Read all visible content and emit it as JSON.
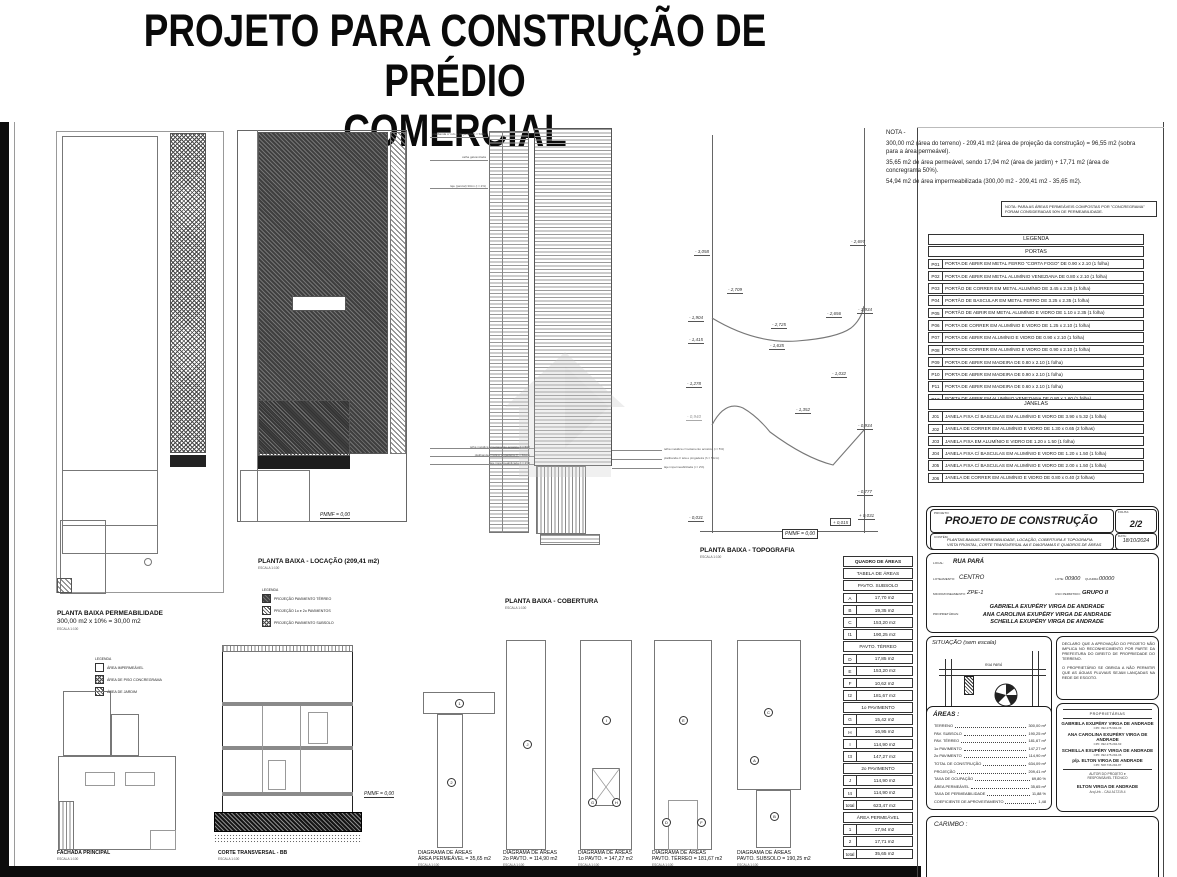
{
  "title": {
    "line1": "PROJETO PARA CONSTRUÇÃO DE PRÉDIO",
    "line2": "COMERCIAL"
  },
  "nota": {
    "heading": "NOTA -",
    "line1": "300,00 m2 (área do terreno) - 209,41 m2 (área de projeção da construção) = 96,55 m2 (sobra para a área permeável).",
    "line2": "35,65 m2 de área permeável, sendo 17,94 m2 (área de jardim) + 17,71 m2 (área de concregrama 50%).",
    "line3": "54,94 m2 de área impermeabilizada (300,00 m2 - 209,41 m2 - 35,65 m2).",
    "boxed": "NOTA: PARA AS ÁREAS PERMEÁVEIS COMPOSTAS POR \"CONCREGRAMA\" FORAM CONSIDERADAS 50% DE PERMEABILIDADE."
  },
  "legenda": {
    "title": "LEGENDA",
    "portas_title": "PORTAS",
    "portas": [
      {
        "code": "P01",
        "desc": "PORTA DE ABRIR EM METAL FERRO \"CORTA FOGO\" DE 0.90 x 2.10 (1 folha)"
      },
      {
        "code": "P02",
        "desc": "PORTA DE ABRIR EM METAL ALUMÍNIO VENEZIANA DE 0.80 x 2.10 (1 folha)"
      },
      {
        "code": "P03",
        "desc": "PORTÃO DE CORRER EM METAL ALUMÍNIO DE 3.45 x 2.35 (1 folha)"
      },
      {
        "code": "P04",
        "desc": "PORTÃO DE BASCULAR EM METAL FERRO DE 3.25 x 2.35 (1 folha)"
      },
      {
        "code": "P05",
        "desc": "PORTÃO DE ABRIR EM METAL ALUMÍNIO E VIDRO DE 1.10 x 2.35 (1 folha)"
      },
      {
        "code": "P06",
        "desc": "PORTA DE CORRER EM ALUMÍNIO E VIDRO DE 1.25 x 2.10 (1 folha)"
      },
      {
        "code": "P07",
        "desc": "PORTA DE ABRIR EM ALUMÍNIO E VIDRO DE 0.90 x 2.10 (1 folha)"
      },
      {
        "code": "P08",
        "desc": "PORTA DE CORRER EM ALUMÍNIO E VIDRO DE 0.90 x 2.10 (1 folha)"
      },
      {
        "code": "P09",
        "desc": "PORTA DE ABRIR EM MADEIRA DE 0.80 x 2.10 (1 folha)"
      },
      {
        "code": "P10",
        "desc": "PORTA DE ABRIR EM MADEIRA DE 0.90 x 2.10 (1 folha)"
      },
      {
        "code": "P11",
        "desc": "PORTA DE ABRIR EM MADEIRA DE 0.60 x 2.10 (1 folha)"
      },
      {
        "code": "P12",
        "desc": "PORTA DE ABRIR EM ALUMÍNIO VENEZIANA DE 0.80 x 1.60 (1 folha)"
      }
    ],
    "janelas_title": "JANELAS",
    "janelas": [
      {
        "code": "J01",
        "desc": "JANELA FIXA C/ BASCULAS EM ALUMÍNIO E VIDRO DE 3.90 x 5.32 (1 folha)"
      },
      {
        "code": "J02",
        "desc": "JANELA DE CORRER EM ALUMÍNIO E VIDRO DE 1.30 x 0.65 (2 folhas)"
      },
      {
        "code": "J03",
        "desc": "JANELA FIXA EM ALUMÍNIO E VIDRO DE 1.20 x 1.50 (1 folha)"
      },
      {
        "code": "J04",
        "desc": "JANELA FIXA C/ BASCULAS EM ALUMÍNIO E VIDRO DE 1.20 x 1.50 (1 folha)"
      },
      {
        "code": "J05",
        "desc": "JANELA FIXA C/ BASCULAS EM ALUMÍNIO E VIDRO DE 2.00 x 1.50 (1 folha)"
      },
      {
        "code": "J06",
        "desc": "JANELA DE CORRER EM ALUMÍNIO E VIDRO DE 0.80 x 0.40 (2 folhas)"
      }
    ]
  },
  "quadro": {
    "title": "QUADRO DE ÁREAS",
    "rows": [
      {
        "h": "TABELA DE ÁREAS"
      },
      {
        "h": "PAVTO. SUBSOLO"
      },
      {
        "l": "A",
        "v": "17,70 m2"
      },
      {
        "l": "B",
        "v": "19,35 m2"
      },
      {
        "l": "C",
        "v": "153,20 m2"
      },
      {
        "l": "t1",
        "v": "190,25 m2"
      },
      {
        "h": "PAVTO. TÉRREO"
      },
      {
        "l": "D",
        "v": "17,85 m2"
      },
      {
        "l": "E",
        "v": "153,20 m2"
      },
      {
        "l": "F",
        "v": "10,62 m2"
      },
      {
        "l": "t2",
        "v": "181,67 m2"
      },
      {
        "h": "1o PAVIMENTO"
      },
      {
        "l": "G",
        "v": "15,42 m2"
      },
      {
        "l": "H",
        "v": "16,95 m2"
      },
      {
        "l": "I",
        "v": "114,90 m2"
      },
      {
        "l": "t3",
        "v": "147,27 m2"
      },
      {
        "h": "2o PAVIMENTO"
      },
      {
        "l": "J",
        "v": "114,90 m2"
      },
      {
        "l": "t4",
        "v": "114,90 m2"
      },
      {
        "l": "total",
        "v": "623,47 m2"
      },
      {
        "h": "ÁREA PERMEÁVEL"
      },
      {
        "l": "1",
        "v": "17,94 m2"
      },
      {
        "l": "2",
        "v": "17,71 m2"
      },
      {
        "l": "total",
        "v": "35,65 m2"
      }
    ]
  },
  "plans": {
    "permeabilidade_l1": "PLANTA BAIXA PERMEABILIDADE",
    "permeabilidade_l2": "300,00 m2 x 10% = 30,00 m2",
    "locacao": "PLANTA BAIXA - LOCAÇÃO (209,41 m2)",
    "cobertura": "PLANTA BAIXA - COBERTURA",
    "topografia": "PLANTA BAIXA - TOPOGRAFIA",
    "fachada": "FACHADA PRINCIPAL",
    "corte": "CORTE TRANSVERSAL - BB",
    "escala": "ESCALA 1:100",
    "pmmf": "PMMF = 0,00"
  },
  "legend_permeavel": {
    "title": "LEGENDA",
    "items": [
      "ÁREA IMPERMEÁVEL",
      "ÁREA DE PISO CONCREGRAMA",
      "ÁREA DE JARDIM"
    ]
  },
  "legend_locacao": {
    "title": "LEGENDA",
    "items": [
      "PROJEÇÃO PAVIMENTO TÉRREO",
      "PROJEÇÃO 1o e 2o PAVIMENTOS",
      "PROJEÇÃO PAVIMENTO SUBSOLO"
    ]
  },
  "topografia": {
    "elevations": [
      {
        "t": "- 3,058",
        "x": 694,
        "y": 249
      },
      {
        "t": "- 2,697",
        "x": 850,
        "y": 239
      },
      {
        "t": "- 2,709",
        "x": 727,
        "y": 287
      },
      {
        "t": "- 1,904",
        "x": 688,
        "y": 315
      },
      {
        "t": "- 2,725",
        "x": 771,
        "y": 322
      },
      {
        "t": "- 2,656",
        "x": 826,
        "y": 311
      },
      {
        "t": "- 1,934",
        "x": 857,
        "y": 307
      },
      {
        "t": "- 1,415",
        "x": 688,
        "y": 337
      },
      {
        "t": "- 1,635",
        "x": 769,
        "y": 343
      },
      {
        "t": "- 1,278",
        "x": 686,
        "y": 381
      },
      {
        "t": "- 1,032",
        "x": 831,
        "y": 371
      },
      {
        "t": "- 0,940",
        "x": 686,
        "y": 414,
        "gray": true
      },
      {
        "t": "- 1,352",
        "x": 795,
        "y": 407
      },
      {
        "t": "- 0,934",
        "x": 857,
        "y": 423
      },
      {
        "t": "- 0,777",
        "x": 857,
        "y": 489
      },
      {
        "t": "- 0,031",
        "x": 688,
        "y": 515
      },
      {
        "t": "+ 0,015",
        "x": 830,
        "y": 518,
        "boxed": true
      },
      {
        "t": "+ 0,031",
        "x": 858,
        "y": 513
      }
    ]
  },
  "anno_cobertura": [
    {
      "t": "platibanda c/ rufo e pingadeira h = 50cm",
      "x": 486,
      "y": 132,
      "side": "l"
    },
    {
      "t": "calha galvanizada",
      "x": 486,
      "y": 155,
      "side": "l"
    },
    {
      "t": "laje (parcial) 30cm (i = 2%)",
      "x": 486,
      "y": 184,
      "side": "l"
    },
    {
      "t": "telha metálica c/ isolamento acústico (i = 5%)",
      "x": 530,
      "y": 445,
      "side": "l"
    },
    {
      "t": "platibanda c/ tela e pingadeira (h = 50cm)",
      "x": 530,
      "y": 453,
      "side": "l"
    },
    {
      "t": "laje impermeabilizada (i = 2%)",
      "x": 530,
      "y": 461,
      "side": "l"
    },
    {
      "t": "telha metálica c/ isolamento acústico (i = 5%)",
      "x": 664,
      "y": 447,
      "side": "r"
    },
    {
      "t": "platibanda c/ tela e pingadeira (h = 50cm)",
      "x": 664,
      "y": 456,
      "side": "r"
    },
    {
      "t": "laje impermeabilizada (i = 2%)",
      "x": 664,
      "y": 465,
      "side": "r"
    }
  ],
  "diagramas": {
    "heading": "DIAGRAMA DE ÁREAS",
    "items": [
      {
        "x": 418,
        "sub": "ÁREA PERMEÁVEL = 35,65 m2"
      },
      {
        "x": 503,
        "sub": "2o PAVTO. = 114,90 m2"
      },
      {
        "x": 578,
        "sub": "1o PAVTO. = 147,27 m2"
      },
      {
        "x": 652,
        "sub": "PAVTO. TÉRREO = 181,67 m2"
      },
      {
        "x": 737,
        "sub": "PAVTO. SUBSOLO = 190,25 m2"
      }
    ],
    "markers": [
      {
        "t": "1",
        "x": 455,
        "y": 699
      },
      {
        "t": "2",
        "x": 447,
        "y": 778
      },
      {
        "t": "J",
        "x": 523,
        "y": 740
      },
      {
        "t": "I",
        "x": 602,
        "y": 716
      },
      {
        "t": "G",
        "x": 588,
        "y": 798
      },
      {
        "t": "H",
        "x": 612,
        "y": 798
      },
      {
        "t": "E",
        "x": 679,
        "y": 716
      },
      {
        "t": "D",
        "x": 662,
        "y": 818
      },
      {
        "t": "F",
        "x": 697,
        "y": 818
      },
      {
        "t": "C",
        "x": 764,
        "y": 708
      },
      {
        "t": "A",
        "x": 750,
        "y": 756
      },
      {
        "t": "B",
        "x": 770,
        "y": 812
      }
    ]
  },
  "titleblock": {
    "projeto_label": "PROJETO:",
    "projeto": "PROJETO DE CONSTRUÇÃO",
    "folha_label": "FOLHA:",
    "folha": "2/2",
    "contem_label": "CONTÉM:",
    "contem1": "PLANTAS BAIXAS PERMEABILIDADE, LOCAÇÃO, COBERTURA E TOPOGRAFIA",
    "contem2": "VISTA FRONTAL, CORTE TRANSVERSAL AA E DIAGRAMAS E QUADROS DE ÁREAS",
    "data_label": "DATA:",
    "data": "18/10/2024",
    "local_label": "LOCAL:",
    "local": "RUA PARÁ",
    "loteamento_label": "LOTEAMENTO:",
    "loteamento": "CENTRO",
    "lote_label": "LOTE:",
    "lote": "00900",
    "quadra_label": "QUADRA:",
    "quadra": "00000",
    "micro_label": "MICROZONEAMENTO:",
    "micro": "ZPE-1",
    "uso_label": "USO PERMITIDO:",
    "uso": "GRUPO II",
    "prop_label": "PROPRIETÁRIAS:",
    "prop1": "GABRIELA EXUPÉRY VIRGA DE ANDRADE",
    "prop2": "ANA CAROLINA EXUPÉRY VIRGA DE ANDRADE",
    "prop3": "SCHEILLA EXUPÉRY VIRGA DE ANDRADE"
  },
  "situacao": {
    "title": "SITUAÇÃO (sem escala)",
    "rua": "RUA PARÁ",
    "north": "N"
  },
  "declaracao": {
    "p1": "DECLARO QUE A APROVAÇÃO DO PROJETO NÃO IMPLICA NO RECONHECIMENTO POR PARTE DA PREFEITURA DO DIREITO DE PROPRIEDADE DO TERRENO.",
    "p2": "O PROPRIETÁRIO SE OBRIGA A NÃO PERMITIR QUE AS ÁGUAS PLUVIAIS SEJAM LANÇADAS NA REDE DE ESGOTO."
  },
  "areas": {
    "title": "ÁREAS :",
    "rows": [
      {
        "l": "TERRENO",
        "v": "300,00 m²"
      },
      {
        "l": "PAV. SUBSOLO",
        "v": "190,25 m²"
      },
      {
        "l": "PAV. TÉRREO",
        "v": "181,67 m²"
      },
      {
        "l": "1o PAVIMENTO",
        "v": "147,27 m²"
      },
      {
        "l": "2o PAVIMENTO",
        "v": "114,90 m²"
      },
      {
        "l": "TOTAL DE CONSTRUÇÃO",
        "v": "634,09 m²"
      },
      {
        "l": "PROJEÇÃO",
        "v": "209,41 m²"
      },
      {
        "l": "TAXA DE OCUPAÇÃO",
        "v": "69,80 %"
      },
      {
        "l": "ÁREA PERMEÁVEL",
        "v": "35,65 m²"
      },
      {
        "l": "TAXA DE PERMEABILIDADE",
        "v": "11,88 %"
      },
      {
        "l": "COEFICIENTE DE APROVEITAMENTO",
        "v": "1,48"
      }
    ]
  },
  "assinaturas": {
    "heading": "PROPRIETÁRIAS",
    "entries": [
      {
        "name": "GABRIELA EXUPÉRY VIRGA DE ANDRADE",
        "cpf": "CPF: 092.275.994-09"
      },
      {
        "name": "ANA CAROLINA EXUPÉRY VIRGA DE ANDRADE",
        "cpf": "CPF: 092.275.294-63"
      },
      {
        "name": "SCHEILLA EXUPÉRY VIRGA DE ANDRADE",
        "cpf": "CPF: 092.275.294-06"
      },
      {
        "name": "p/p. ELTON VIRGA DE ANDRADE",
        "cpf": "CPF: 508.736.294-87"
      }
    ],
    "autor1": "AUTOR DO PROJETO e",
    "autor2": "RESPONSÁVEL TÉCNICO",
    "autor_nome": "ELTON VIRGA DE ANDRADE",
    "autor_reg": "Arq.Urb. - CAU A17219-4"
  },
  "carimbo": {
    "title": "CARIMBO :"
  }
}
